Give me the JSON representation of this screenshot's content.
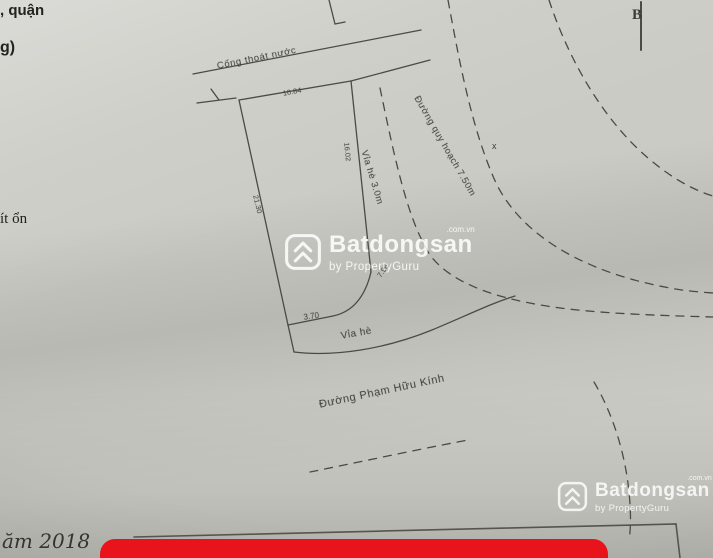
{
  "drawing": {
    "north_label": "B",
    "labels": {
      "drain": "Cống thoát nước",
      "drain_dim": "10.84",
      "left_dim": "21.30",
      "right_dim": "16.02",
      "bottom_dim": "3.70",
      "corner_dim": "7.96",
      "sidewalk_right": "Vỉa hè 3.0m",
      "planned_road": "Đường quy hoạch 7.50m",
      "sidewalk_bottom": "Vỉa hè",
      "street_name": "Đường Phạm Hữu Kính",
      "x_mark": "x"
    }
  },
  "page_fragments": {
    "top_line1": ", quận",
    "top_line2": "g)",
    "mid_line": "ít ổn",
    "handwriting": "ăm 2018"
  },
  "watermark": {
    "brand": "Batdongsan",
    "domain": ".com.vn",
    "byline": "by PropertyGuru"
  },
  "colors": {
    "paper": "#cbcbc5",
    "ink": "#4b4a45",
    "banner_red": "#e8131b",
    "watermark_white": "#ffffff"
  }
}
